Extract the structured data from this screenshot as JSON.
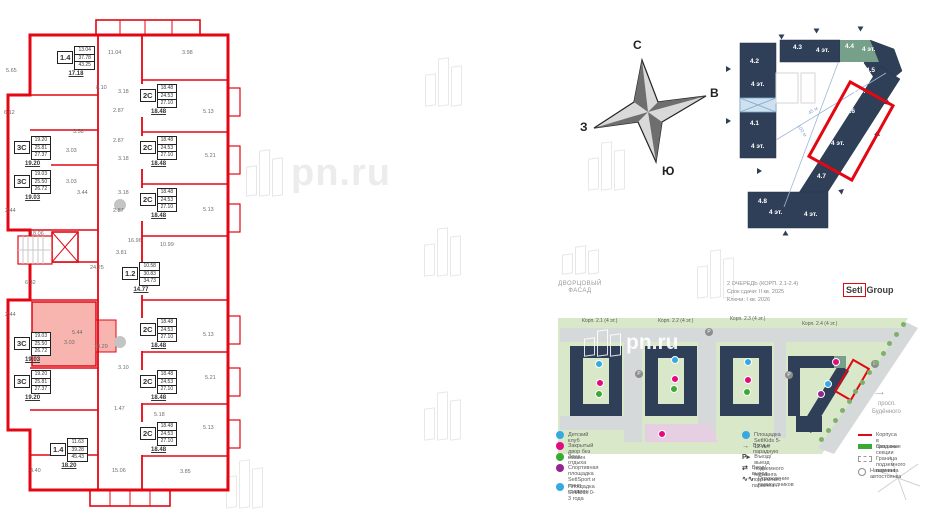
{
  "watermark": {
    "text": "pn.ru"
  },
  "compass": {
    "north": "С",
    "east": "В",
    "south": "Ю",
    "west": "З"
  },
  "floorplan": {
    "stamps": [
      {
        "type": "1.4",
        "rows": [
          "13.04",
          "37.78",
          "43.25"
        ],
        "total": "17.18",
        "x": 57,
        "y": 46,
        "hl": false
      },
      {
        "type": "2С",
        "rows": [
          "18.48",
          "24.53",
          "27.10"
        ],
        "total": "18.48",
        "x": 140,
        "y": 84,
        "hl": false
      },
      {
        "type": "2С",
        "rows": [
          "18.48",
          "24.53",
          "27.10"
        ],
        "total": "18.48",
        "x": 140,
        "y": 136,
        "hl": false
      },
      {
        "type": "2С",
        "rows": [
          "18.48",
          "24.53",
          "27.10"
        ],
        "total": "18.48",
        "x": 140,
        "y": 188,
        "hl": false
      },
      {
        "type": "3С",
        "rows": [
          "19.20",
          "25.81",
          "27.37"
        ],
        "total": "19.20",
        "x": 14,
        "y": 136,
        "hl": false
      },
      {
        "type": "3С",
        "rows": [
          "19.03",
          "25.50",
          "26.72"
        ],
        "total": "19.03",
        "x": 14,
        "y": 170,
        "hl": false
      },
      {
        "type": "1.2",
        "rows": [
          "10.58",
          "30.83",
          "34.73"
        ],
        "total": "14.77",
        "x": 122,
        "y": 262,
        "hl": false
      },
      {
        "type": "3С",
        "rows": [
          "19.03",
          "25.50",
          "26.72"
        ],
        "total": "19.03",
        "x": 14,
        "y": 332,
        "hl": true
      },
      {
        "type": "3С",
        "rows": [
          "19.20",
          "25.81",
          "27.37"
        ],
        "total": "19.20",
        "x": 14,
        "y": 370,
        "hl": false
      },
      {
        "type": "2С",
        "rows": [
          "18.48",
          "24.53",
          "27.10"
        ],
        "total": "18.48",
        "x": 140,
        "y": 318,
        "hl": false
      },
      {
        "type": "2С",
        "rows": [
          "18.48",
          "24.53",
          "27.10"
        ],
        "total": "18.48",
        "x": 140,
        "y": 370,
        "hl": false
      },
      {
        "type": "2С",
        "rows": [
          "18.48",
          "24.53",
          "27.10"
        ],
        "total": "18.48",
        "x": 140,
        "y": 422,
        "hl": false
      },
      {
        "type": "1.4",
        "rows": [
          "11.63",
          "39.28",
          "45.43"
        ],
        "total": "18.20",
        "x": 50,
        "y": 438,
        "hl": false
      }
    ],
    "dims": [
      {
        "v": "5.65",
        "x": 6,
        "y": 68
      },
      {
        "v": "11.04",
        "x": 108,
        "y": 50
      },
      {
        "v": "3.98",
        "x": 182,
        "y": 50
      },
      {
        "v": "8.10",
        "x": 96,
        "y": 85
      },
      {
        "v": "3.18",
        "x": 118,
        "y": 89
      },
      {
        "v": "6.12",
        "x": 4,
        "y": 110
      },
      {
        "v": "5.13",
        "x": 203,
        "y": 109
      },
      {
        "v": "2.87",
        "x": 113,
        "y": 108
      },
      {
        "v": "3.58",
        "x": 73,
        "y": 129
      },
      {
        "v": "2.87",
        "x": 113,
        "y": 138
      },
      {
        "v": "3.03",
        "x": 66,
        "y": 148
      },
      {
        "v": "3.18",
        "x": 118,
        "y": 156
      },
      {
        "v": "5.21",
        "x": 205,
        "y": 153
      },
      {
        "v": "3.03",
        "x": 66,
        "y": 179
      },
      {
        "v": "3.44",
        "x": 77,
        "y": 190
      },
      {
        "v": "3.18",
        "x": 118,
        "y": 190
      },
      {
        "v": "2.44",
        "x": 5,
        "y": 208
      },
      {
        "v": "2.87",
        "x": 113,
        "y": 208
      },
      {
        "v": "5.13",
        "x": 203,
        "y": 207
      },
      {
        "v": "18.06",
        "x": 30,
        "y": 231
      },
      {
        "v": "16.96",
        "x": 128,
        "y": 238
      },
      {
        "v": "10.99",
        "x": 160,
        "y": 242
      },
      {
        "v": "3.81",
        "x": 116,
        "y": 250
      },
      {
        "v": "24.25",
        "x": 90,
        "y": 265
      },
      {
        "v": "6.32",
        "x": 25,
        "y": 280
      },
      {
        "v": "2.44",
        "x": 5,
        "y": 312
      },
      {
        "v": "5.44",
        "x": 72,
        "y": 330
      },
      {
        "v": "3.03",
        "x": 64,
        "y": 340
      },
      {
        "v": "18.29",
        "x": 94,
        "y": 344
      },
      {
        "v": "5.13",
        "x": 203,
        "y": 332
      },
      {
        "v": "3.10",
        "x": 118,
        "y": 365
      },
      {
        "v": "5.21",
        "x": 205,
        "y": 375
      },
      {
        "v": "1.47",
        "x": 114,
        "y": 406
      },
      {
        "v": "5.18",
        "x": 154,
        "y": 412
      },
      {
        "v": "5.13",
        "x": 203,
        "y": 425
      },
      {
        "v": "4.40",
        "x": 30,
        "y": 468
      },
      {
        "v": "15.06",
        "x": 112,
        "y": 468
      },
      {
        "v": "3.85",
        "x": 180,
        "y": 469
      }
    ]
  },
  "scheme": {
    "selected_section": "4.6",
    "labels": [
      {
        "t": "4.2",
        "x": 750,
        "y": 58
      },
      {
        "t": "4 эт.",
        "x": 751,
        "y": 81
      },
      {
        "t": "4.1",
        "x": 750,
        "y": 120
      },
      {
        "t": "4 эт.",
        "x": 751,
        "y": 143
      },
      {
        "t": "4.3",
        "x": 793,
        "y": 44
      },
      {
        "t": "4 эт.",
        "x": 816,
        "y": 47
      },
      {
        "t": "4.4",
        "x": 845,
        "y": 43
      },
      {
        "t": "4 эт.",
        "x": 862,
        "y": 46
      },
      {
        "t": "4.5",
        "x": 866,
        "y": 67
      },
      {
        "t": "4 эт.",
        "x": 852,
        "y": 88
      },
      {
        "t": "4.6",
        "x": 846,
        "y": 108
      },
      {
        "t": "4 эт.",
        "x": 831,
        "y": 140
      },
      {
        "t": "4.7",
        "x": 817,
        "y": 173
      },
      {
        "t": "4.8",
        "x": 758,
        "y": 198
      },
      {
        "t": "4 эт.",
        "x": 769,
        "y": 209
      },
      {
        "t": "4 эт.",
        "x": 804,
        "y": 211
      }
    ],
    "dim_labels": [
      {
        "t": "45 м",
        "x": 808,
        "y": 108,
        "r": -32
      },
      {
        "t": "100 м",
        "x": 795,
        "y": 128,
        "r": 56
      }
    ],
    "arrows": [
      {
        "x": 814,
        "y": 28,
        "r": 90
      },
      {
        "x": 858,
        "y": 26,
        "r": 90
      },
      {
        "x": 779,
        "y": 34,
        "r": 90
      },
      {
        "x": 726,
        "y": 66,
        "r": 0
      },
      {
        "x": 726,
        "y": 118,
        "r": 0
      },
      {
        "x": 757,
        "y": 168,
        "r": 0
      },
      {
        "x": 884,
        "y": 100,
        "r": 160
      },
      {
        "x": 874,
        "y": 131,
        "r": 160
      },
      {
        "x": 838,
        "y": 188,
        "r": 200
      },
      {
        "x": 783,
        "y": 230,
        "r": 270
      }
    ]
  },
  "queue": {
    "line1": "2 очередь (корп. 2.1-2.4)",
    "line2": "Срок сдачи: II кв. 2025",
    "line3": "Ключи: I кв. 2026"
  },
  "developer": {
    "setl": "Setl",
    "group": "Group"
  },
  "project": {
    "line1": "ДВОРЦОВЫЙ",
    "line2": "ФАСАД"
  },
  "siteplan": {
    "corpuses": [
      {
        "label": "Корп. 2.1 (4 эт.)",
        "x": 582,
        "y": 318
      },
      {
        "label": "Корп. 2.2 (4 эт.)",
        "x": 658,
        "y": 318
      },
      {
        "label": "Корп. 2.3 (4 эт.)",
        "x": 730,
        "y": 316
      },
      {
        "label": "Корп. 2.4 (4 эт.)",
        "x": 802,
        "y": 321
      }
    ],
    "street": {
      "line1": "просп.",
      "line2": "Будённого"
    },
    "parking_letter": "Р",
    "icons": [
      {
        "x": 595,
        "y": 360,
        "c": "#36a9e1"
      },
      {
        "x": 596,
        "y": 379,
        "c": "#e5097f"
      },
      {
        "x": 595,
        "y": 390,
        "c": "#3aaa35"
      },
      {
        "x": 671,
        "y": 356,
        "c": "#36a9e1"
      },
      {
        "x": 671,
        "y": 375,
        "c": "#e5097f"
      },
      {
        "x": 670,
        "y": 385,
        "c": "#3aaa35"
      },
      {
        "x": 744,
        "y": 358,
        "c": "#36a9e1"
      },
      {
        "x": 744,
        "y": 376,
        "c": "#e5097f"
      },
      {
        "x": 743,
        "y": 388,
        "c": "#3aaa35"
      },
      {
        "x": 832,
        "y": 358,
        "c": "#e5097f"
      },
      {
        "x": 824,
        "y": 380,
        "c": "#36a9e1"
      },
      {
        "x": 817,
        "y": 390,
        "c": "#93268f"
      },
      {
        "x": 658,
        "y": 430,
        "c": "#e5097f"
      }
    ],
    "parking_spots": [
      {
        "x": 705,
        "y": 328
      },
      {
        "x": 635,
        "y": 370
      },
      {
        "x": 785,
        "y": 371
      },
      {
        "x": 871,
        "y": 360
      }
    ]
  },
  "legend": {
    "col1": [
      {
        "color": "#36a9e1",
        "label": "Детский клуб"
      },
      {
        "color": "#e5097f",
        "label": "Закрытый двор без машин"
      },
      {
        "color": "#3aaa35",
        "label": "Зона отдыха"
      },
      {
        "color": "#93268f",
        "label": "Спортивная площадка SetlSport и мини-стадион"
      },
      {
        "color": "#36a9e1",
        "label": "Площадка SetlKids 0-3 года"
      }
    ],
    "col2": [
      {
        "icon": "circle",
        "color": "#36a9e1",
        "label": "Площадка SetlKids 5-12 лет"
      },
      {
        "icon": "arrow",
        "label": "Вход в парадную"
      },
      {
        "icon": "parking-entry",
        "label": "Въезд/выезд подземного паркинга"
      },
      {
        "icon": "pedestrian",
        "label": "Вход/выход подземного паркинга"
      },
      {
        "icon": "fence",
        "label": "Ограждение палисадников"
      }
    ],
    "col3": [
      {
        "icon": "red-line",
        "color": "#e30613",
        "label": "Корпуса в продаже"
      },
      {
        "icon": "green-rect",
        "color": "#3aaa35",
        "label": "Сквозные секции"
      },
      {
        "icon": "dashed-rect",
        "label": "Граница подземного паркинга"
      },
      {
        "icon": "parking-circle",
        "label": "Наземная автостоянка"
      }
    ]
  }
}
